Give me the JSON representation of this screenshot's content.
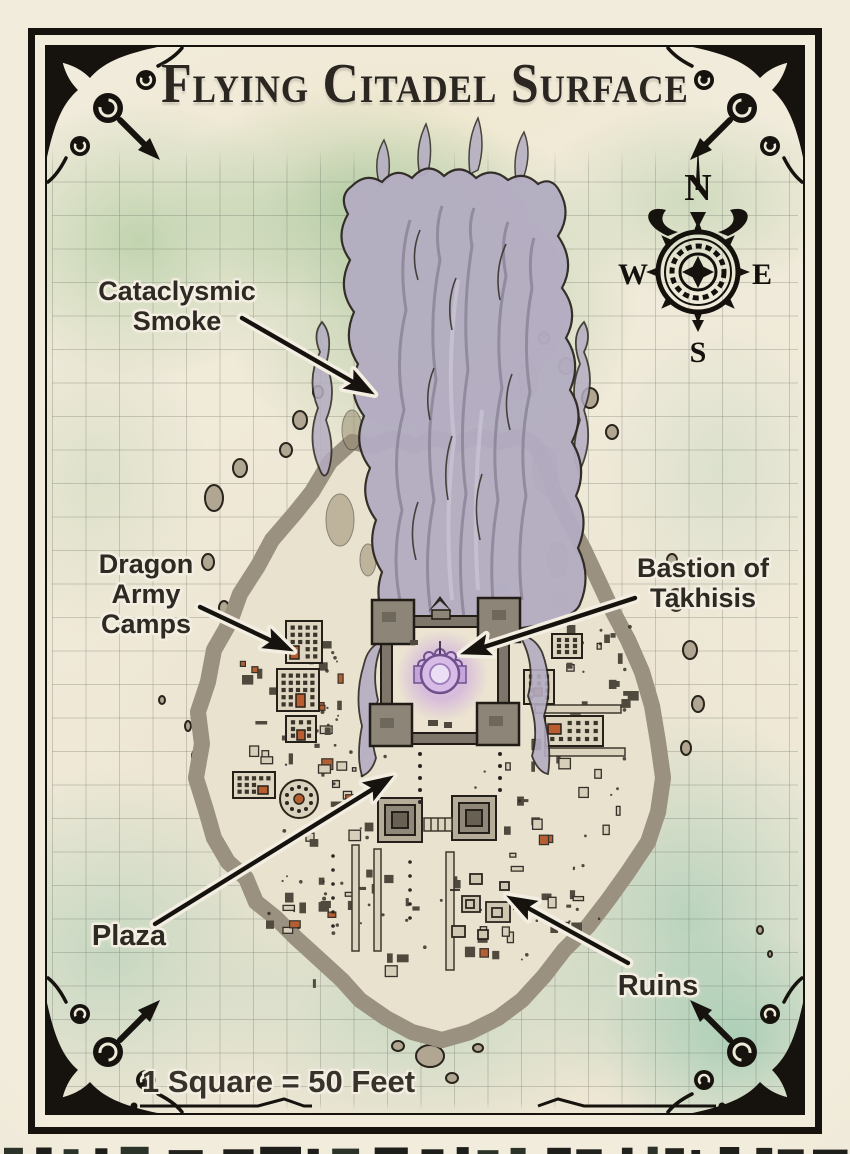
{
  "page": {
    "title": "Flying Citadel Surface",
    "scale_note": "1 Square = 50 Feet"
  },
  "labels": {
    "smoke": "Cataclysmic Smoke",
    "camps": "Dragon Army Camps",
    "bastion": "Bastion of Takhisis",
    "plaza": "Plaza",
    "ruins": "Ruins"
  },
  "compass": {
    "n": "N",
    "e": "E",
    "s": "S",
    "w": "W"
  },
  "colors": {
    "parchment": "#efe9d8",
    "ink": "#16130f",
    "smoke": "#b4adc2",
    "arcane_glow": "#c9a2e0",
    "wash_green": "#8bb880",
    "wash_teal": "#86c0a6",
    "rock": "#9a9181",
    "island": "#e9e2cf",
    "camp_accent": "#b95c30"
  }
}
